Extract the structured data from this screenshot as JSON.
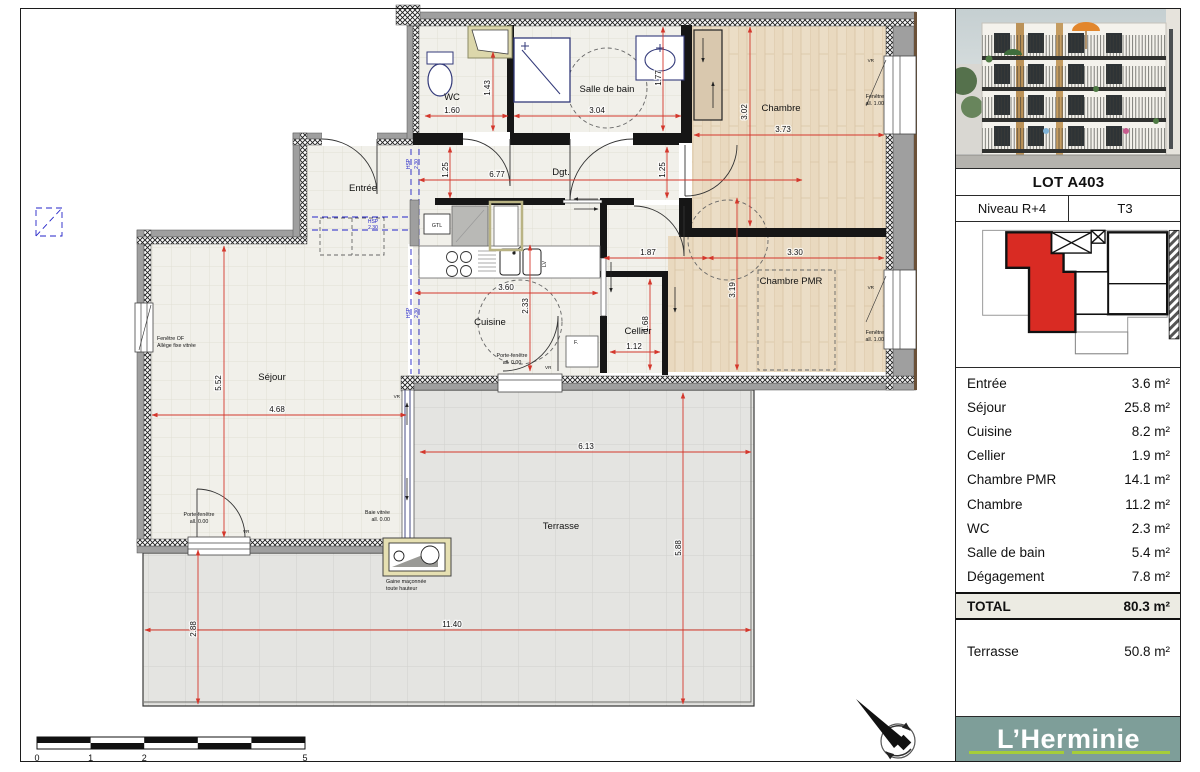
{
  "sidebar": {
    "lot": "LOT A403",
    "niveau": "Niveau R+4",
    "type": "T3",
    "areas": [
      {
        "label": "Entrée",
        "value": "3.6 m²"
      },
      {
        "label": "Séjour",
        "value": "25.8 m²"
      },
      {
        "label": "Cuisine",
        "value": "8.2 m²"
      },
      {
        "label": "Cellier",
        "value": "1.9 m²"
      },
      {
        "label": "Chambre PMR",
        "value": "14.1 m²"
      },
      {
        "label": "Chambre",
        "value": "11.2 m²"
      },
      {
        "label": "WC",
        "value": "2.3 m²"
      },
      {
        "label": "Salle de bain",
        "value": "5.4 m²"
      },
      {
        "label": "Dégagement",
        "value": "7.8 m²"
      }
    ],
    "total_label": "TOTAL",
    "total_value": "80.3 m²",
    "terrasse_label": "Terrasse",
    "terrasse_value": "50.8 m²",
    "brand": "L’Herminie",
    "accent_teal": "#7E9E99",
    "accent_green": "#a5cd39",
    "keyplan_unit_color": "#d92b23"
  },
  "plan": {
    "rooms": {
      "entree": "Entrée",
      "sejour": "Séjour",
      "cuisine": "Cuisine",
      "cellier": "Cellier",
      "chambre_pmr": "Chambre PMR",
      "chambre": "Chambre",
      "wc": "WC",
      "salle_de_bain": "Salle de bain",
      "dgt": "Dgt.",
      "terrasse": "Terrasse"
    },
    "labels": {
      "gtl": "GTL",
      "f": "F.",
      "lv": "LV",
      "vr": "VR",
      "hsp": "HSP",
      "hsp_value": "2.30"
    },
    "dims": {
      "wc_w": "1.60",
      "wc_h": "1.43",
      "sdb_w": "3.04",
      "sdb_h": "1.77",
      "dgt_l": "6.77",
      "dgt_w1": "1.25",
      "dgt_w2": "1.25",
      "chambre_w": "3.73",
      "chambre_h": "3.02",
      "pmr_w": "3.30",
      "pmr_h": "3.19",
      "pmr_entry": "1.87",
      "cellier_w": "1.12",
      "cellier_h": "1.68",
      "cuisine_w": "3.60",
      "cuisine_h": "2.33",
      "sejour_w": "4.68",
      "sejour_h": "5.52",
      "terrasse_w": "6.13",
      "terrasse_h": "5.88",
      "terrasse_total_w": "11.40",
      "terrasse_left_h": "2.88",
      "dim_color": "#d4372c"
    },
    "annotations": {
      "fenetre_of_l1": "Fenêtre OF",
      "fenetre_of_l2": "Allège fixe vitrée",
      "pf_l1": "Porte-fenêtre",
      "pf_l2": "all. 0.00",
      "baie_l1": "Baie vitrée",
      "baie_l2": "all. 0.00",
      "gaine_l1": "Gaine maçonnée",
      "gaine_l2": "toute hauteur",
      "fen_l1": "Fenêtre",
      "fen_l2": "all. 1.00"
    },
    "scale": {
      "s0": "0",
      "s1": "1",
      "s2": "2",
      "s5": "5"
    }
  }
}
